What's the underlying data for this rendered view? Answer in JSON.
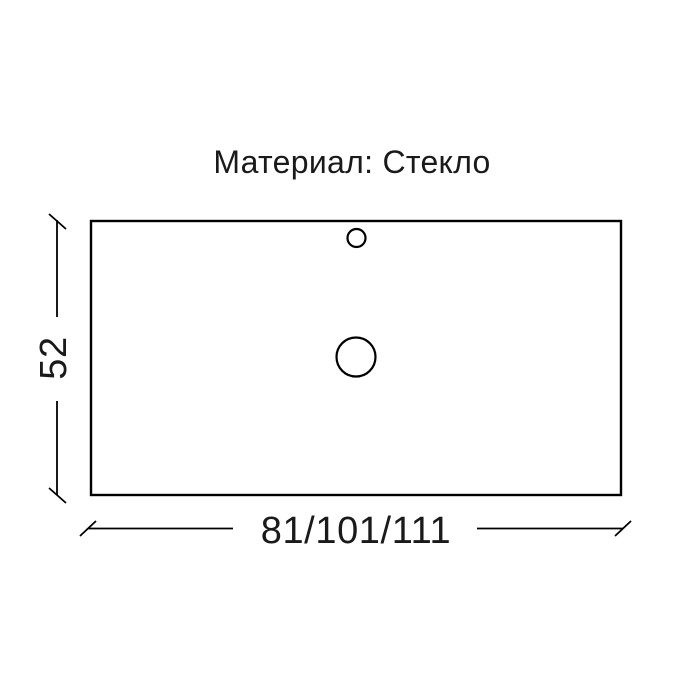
{
  "title": "Материал: Стекло",
  "drawing": {
    "width_dimension_label": "81/101/111",
    "height_dimension_label": "52",
    "shape": "rectangle-top-view",
    "holes": [
      {
        "name": "faucet-hole",
        "size": "small"
      },
      {
        "name": "drain-hole",
        "size": "large"
      }
    ]
  },
  "colors": {
    "background": "#ffffff",
    "line": "#000000",
    "text": "#1a1a1a"
  }
}
